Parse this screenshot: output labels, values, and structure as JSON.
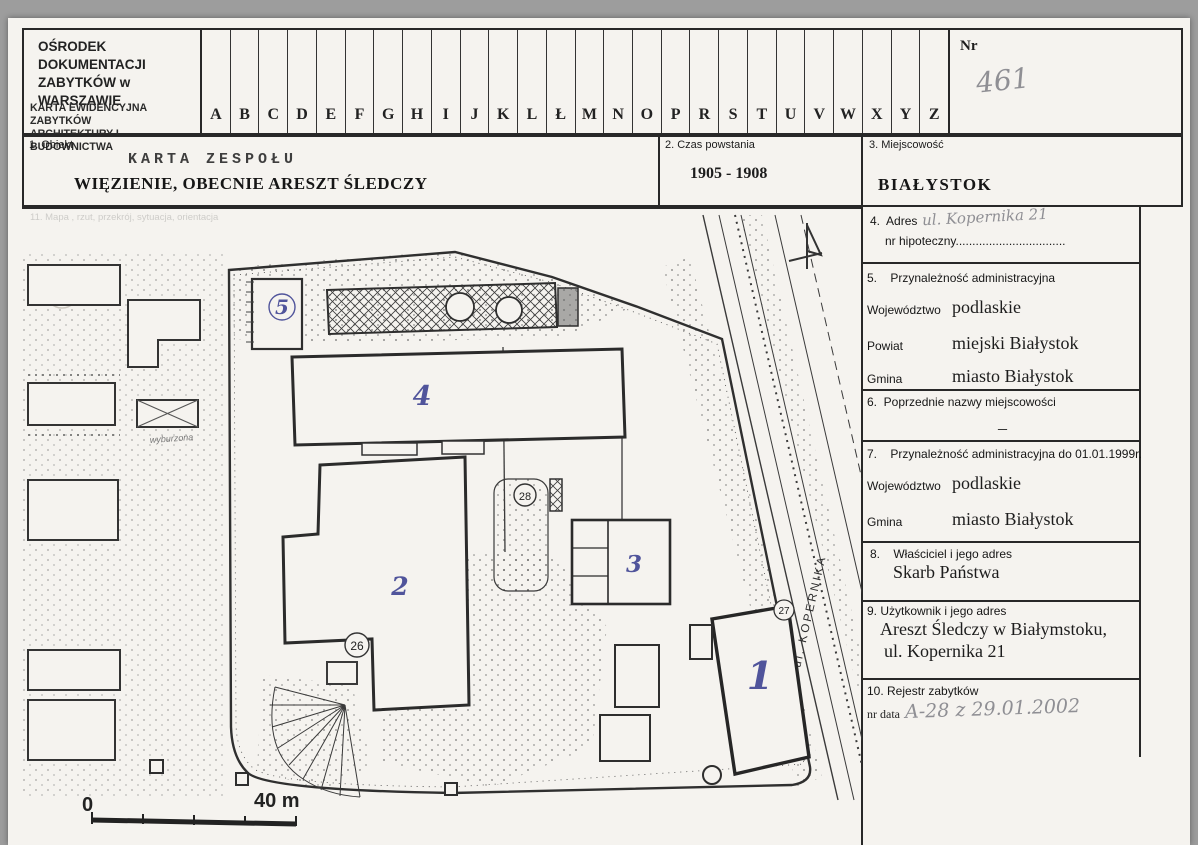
{
  "document": {
    "org_line1": "OŚRODEK DOKUMENTACJI",
    "org_line2": "ZABYTKÓW w WARSZAWIE",
    "card_line1": "KARTA EWIDENCYJNA ZABYTKÓW",
    "card_line2": "ARCHITEKTURY I BUDOWNICTWA",
    "letters": [
      "A",
      "B",
      "C",
      "D",
      "E",
      "F",
      "G",
      "H",
      "I",
      "J",
      "K",
      "L",
      "Ł",
      "M",
      "N",
      "O",
      "P",
      "R",
      "S",
      "T",
      "U",
      "V",
      "W",
      "X",
      "Y",
      "Z"
    ],
    "nr_label": "Nr",
    "nr_value": "461"
  },
  "object_row": {
    "label": "1. Obiekt",
    "stamp": "KARTA ZESPOŁU",
    "name": "WIĘZIENIE, OBECNIE ARESZT ŚLEDCZY"
  },
  "czas": {
    "label": "2. Czas powstania",
    "value": "1905 - 1908"
  },
  "miejscowosc": {
    "label": "3. Miejscowość",
    "value": "BIAŁYSTOK"
  },
  "fields": {
    "adres": {
      "label": "4.  Adres",
      "value": "ul. Kopernika 21",
      "sub": "nr hipoteczny................................."
    },
    "admin": {
      "label": "5.    Przynależność administracyjna",
      "rows": [
        {
          "k": "Województwo",
          "v": "podlaskie"
        },
        {
          "k": "Powiat",
          "v": "miejski Białystok"
        },
        {
          "k": "Gmina",
          "v": "miasto Białystok"
        }
      ]
    },
    "poprzednie": {
      "label": "6.  Poprzednie nazwy miejscowości",
      "value": "–"
    },
    "admin1999": {
      "label": "7.    Przynależność administracyjna do 01.01.1999r.",
      "rows": [
        {
          "k": "Województwo",
          "v": "podlaskie"
        },
        {
          "k": "Gmina",
          "v": "miasto Białystok"
        }
      ]
    },
    "wlasciciel": {
      "label": "8.    Właściciel i jego adres",
      "value": "Skarb Państwa"
    },
    "uzytkownik": {
      "label": "9. Użytkownik i jego adres",
      "line1": "Areszt Śledczy w Białymstoku,",
      "line2": "ul. Kopernika 21"
    },
    "rejestr": {
      "label": "10. Rejestr zabytków",
      "sub": "nr data",
      "value": "A-28   z 29.01.2002"
    }
  },
  "plan": {
    "faint_header": "11. Mapa , rzut, przekrój, sytuacja, orientacja",
    "street": "ul. KOPERNIKA",
    "buildings": [
      "1",
      "2",
      "3",
      "4",
      "5"
    ],
    "circled": [
      "26",
      "27",
      "28"
    ],
    "note": "wyburzona",
    "scale_start": "0",
    "scale_end": "40 m"
  }
}
